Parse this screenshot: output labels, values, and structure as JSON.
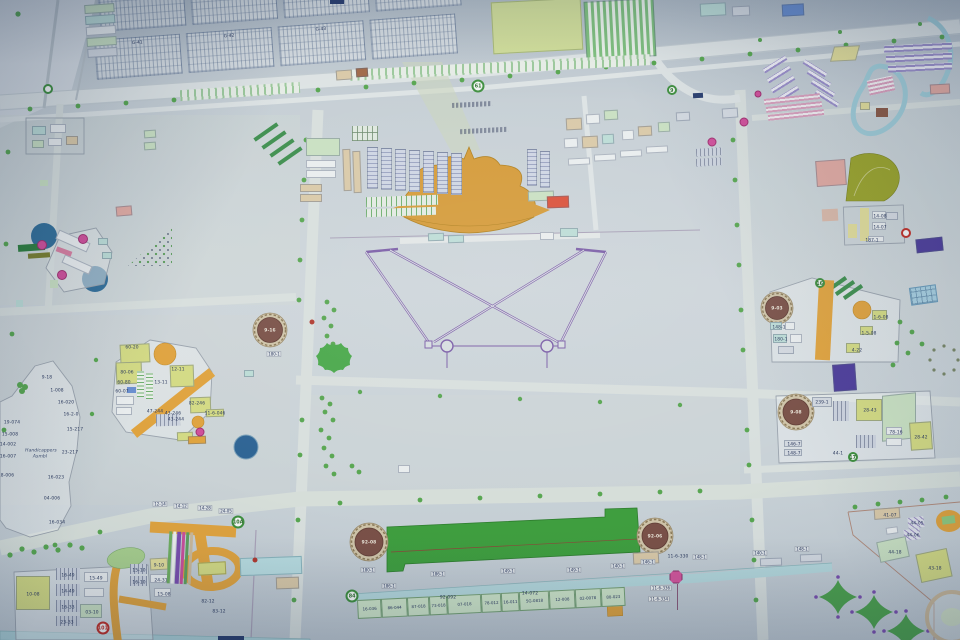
{
  "map": {
    "parking": {
      "row1": [
        {
          "t": "10-44"
        },
        {
          "t": "G-31"
        },
        {
          "t": "G-36"
        },
        {
          "t": ""
        }
      ],
      "row2": [
        {
          "t": "G-41"
        },
        {
          "t": "G-42"
        },
        {
          "t": "G-43"
        },
        {
          "t": ""
        }
      ]
    },
    "bottom_row": {
      "cells": [
        {
          "t": "16-036",
          "w": 24
        },
        {
          "t": "86-044",
          "w": 26
        },
        {
          "t": "87-018",
          "w": 22
        },
        {
          "t": "73-018",
          "w": 18
        },
        {
          "t": "07-018",
          "w": 34
        },
        {
          "t": "78-012",
          "w": 20
        },
        {
          "t": "16-011",
          "w": 18
        },
        {
          "t": "5G-0818",
          "w": 30
        },
        {
          "t": "12-008",
          "w": 26
        },
        {
          "t": "02-0078",
          "w": 26
        },
        {
          "t": "80-023",
          "w": 24
        }
      ]
    },
    "labels": [
      {
        "t": "10-08",
        "x": 33,
        "y": 594
      },
      {
        "t": "16-49",
        "x": 68,
        "y": 575
      },
      {
        "t": "14-49",
        "x": 68,
        "y": 591
      },
      {
        "t": "16-33",
        "x": 68,
        "y": 607
      },
      {
        "t": "23-33",
        "x": 67,
        "y": 622
      },
      {
        "t": "15-49",
        "x": 96,
        "y": 578
      },
      {
        "t": "03-10",
        "x": 92,
        "y": 612
      },
      {
        "t": "9-10",
        "x": 159,
        "y": 565
      },
      {
        "t": "15-10",
        "x": 139,
        "y": 570
      },
      {
        "t": "16-10",
        "x": 139,
        "y": 582
      },
      {
        "t": "24-31",
        "x": 161,
        "y": 580
      },
      {
        "t": "15-08",
        "x": 164,
        "y": 594
      },
      {
        "t": "82-12",
        "x": 208,
        "y": 601
      },
      {
        "t": "83-12",
        "x": 219,
        "y": 611
      },
      {
        "t": "92-092",
        "x": 448,
        "y": 597
      },
      {
        "t": "14-072",
        "x": 530,
        "y": 593
      },
      {
        "t": "11-6-046",
        "x": 215,
        "y": 413
      },
      {
        "t": "11-6-330",
        "x": 678,
        "y": 556
      },
      {
        "t": "9-18",
        "x": 47,
        "y": 377
      },
      {
        "t": "1-008",
        "x": 57,
        "y": 390
      },
      {
        "t": "16-020",
        "x": 66,
        "y": 402
      },
      {
        "t": "16-2-0",
        "x": 71,
        "y": 414
      },
      {
        "t": "15-217",
        "x": 75,
        "y": 429
      },
      {
        "t": "23-217",
        "x": 70,
        "y": 452
      },
      {
        "t": "16-023",
        "x": 56,
        "y": 477
      },
      {
        "t": "04-006",
        "x": 52,
        "y": 498
      },
      {
        "t": "16-034",
        "x": 57,
        "y": 522
      },
      {
        "t": "19-074",
        "x": 12,
        "y": 422
      },
      {
        "t": "15-008",
        "x": 10,
        "y": 434
      },
      {
        "t": "14-002",
        "x": 8,
        "y": 444
      },
      {
        "t": "16-007",
        "x": 8,
        "y": 456
      },
      {
        "t": "18-006",
        "x": 6,
        "y": 475
      },
      {
        "t": "Handicappers",
        "x": 41,
        "y": 450,
        "cls": "ital"
      },
      {
        "t": "Asmbl",
        "x": 40,
        "y": 456,
        "cls": "ital"
      },
      {
        "t": "60-20",
        "x": 132,
        "y": 347
      },
      {
        "t": "80-06",
        "x": 127,
        "y": 372
      },
      {
        "t": "60-80",
        "x": 124,
        "y": 382
      },
      {
        "t": "60-07",
        "x": 122,
        "y": 391
      },
      {
        "t": "12-11",
        "x": 178,
        "y": 369
      },
      {
        "t": "13-11",
        "x": 161,
        "y": 382
      },
      {
        "t": "82-246",
        "x": 197,
        "y": 403
      },
      {
        "t": "47-244",
        "x": 155,
        "y": 411
      },
      {
        "t": "43-246",
        "x": 173,
        "y": 413
      },
      {
        "t": "43-244",
        "x": 176,
        "y": 419
      },
      {
        "t": "148-1",
        "x": 779,
        "y": 327
      },
      {
        "t": "180-1",
        "x": 781,
        "y": 339
      },
      {
        "t": "1-6-08",
        "x": 881,
        "y": 317
      },
      {
        "t": "1-5-08",
        "x": 869,
        "y": 333
      },
      {
        "t": "4-22",
        "x": 857,
        "y": 350
      },
      {
        "t": "239-1",
        "x": 822,
        "y": 402
      },
      {
        "t": "28-43",
        "x": 870,
        "y": 410
      },
      {
        "t": "28-42",
        "x": 921,
        "y": 437
      },
      {
        "t": "78-16",
        "x": 896,
        "y": 432
      },
      {
        "t": "146-7",
        "x": 794,
        "y": 444
      },
      {
        "t": "148-7",
        "x": 794,
        "y": 453
      },
      {
        "t": "44-1",
        "x": 838,
        "y": 453
      },
      {
        "t": "14-08",
        "x": 880,
        "y": 216
      },
      {
        "t": "14-07",
        "x": 880,
        "y": 227
      },
      {
        "t": "187-1",
        "x": 872,
        "y": 240
      },
      {
        "t": "41-07",
        "x": 890,
        "y": 515
      },
      {
        "t": "44-05",
        "x": 917,
        "y": 523
      },
      {
        "t": "44-06",
        "x": 913,
        "y": 535
      },
      {
        "t": "44-18",
        "x": 895,
        "y": 552
      },
      {
        "t": "43-18",
        "x": 935,
        "y": 568
      },
      {
        "t": "92-08",
        "x": 369,
        "y": 542,
        "cls": "ondark"
      },
      {
        "t": "92-06",
        "x": 655,
        "y": 536,
        "cls": "ondark"
      },
      {
        "t": "9-16",
        "x": 270,
        "y": 330,
        "cls": "ondark"
      },
      {
        "t": "9-03",
        "x": 777,
        "y": 308,
        "cls": "ondark"
      },
      {
        "t": "9-08",
        "x": 796,
        "y": 412,
        "cls": "ondark"
      }
    ],
    "tags": [
      {
        "t": "180-1",
        "x": 368,
        "y": 570
      },
      {
        "t": "186-1",
        "x": 389,
        "y": 586
      },
      {
        "t": "186-1",
        "x": 438,
        "y": 574
      },
      {
        "t": "149-1",
        "x": 508,
        "y": 571
      },
      {
        "t": "149-1",
        "x": 574,
        "y": 570
      },
      {
        "t": "140-1",
        "x": 618,
        "y": 566
      },
      {
        "t": "146-1",
        "x": 648,
        "y": 562
      },
      {
        "t": "148-1",
        "x": 700,
        "y": 557
      },
      {
        "t": "140-1",
        "x": 760,
        "y": 553
      },
      {
        "t": "148-1",
        "x": 802,
        "y": 549
      },
      {
        "t": "180-1",
        "x": 274,
        "y": 354
      },
      {
        "t": "12-14",
        "x": 160,
        "y": 504
      },
      {
        "t": "14-12",
        "x": 181,
        "y": 506
      },
      {
        "t": "14-28",
        "x": 205,
        "y": 508
      },
      {
        "t": "24-05",
        "x": 226,
        "y": 511
      }
    ],
    "boxed": [
      {
        "t": "11-6-336",
        "x": 661,
        "y": 588
      },
      {
        "t": "11-6-334",
        "x": 659,
        "y": 599
      }
    ],
    "badges": [
      {
        "t": "101",
        "x": 103,
        "y": 628,
        "cls": "br"
      },
      {
        "t": "",
        "x": 906,
        "y": 233,
        "cls": "br sm"
      },
      {
        "t": "84",
        "x": 352,
        "y": 596,
        "cls": "bg"
      },
      {
        "t": "10A",
        "x": 238,
        "y": 522,
        "cls": "bg"
      },
      {
        "t": "16",
        "x": 820,
        "y": 283,
        "cls": "bg sm"
      },
      {
        "t": "17",
        "x": 853,
        "y": 457,
        "cls": "bg sm"
      },
      {
        "t": "61",
        "x": 478,
        "y": 86,
        "cls": "bg"
      },
      {
        "t": "9",
        "x": 672,
        "y": 90,
        "cls": "bg sm"
      },
      {
        "t": "",
        "x": 48,
        "y": 89,
        "cls": "bg sm"
      },
      {
        "t": "",
        "x": 676,
        "y": 577,
        "cls": "boct"
      },
      {
        "t": "",
        "x": 712,
        "y": 142,
        "cls": "bm"
      },
      {
        "t": "",
        "x": 744,
        "y": 122,
        "cls": "bm"
      },
      {
        "t": "",
        "x": 758,
        "y": 94,
        "cls": "bm sm"
      },
      {
        "t": "",
        "x": 200,
        "y": 432,
        "cls": "bm"
      },
      {
        "t": "",
        "x": 42,
        "y": 245,
        "cls": "bm lg"
      },
      {
        "t": "",
        "x": 83,
        "y": 239,
        "cls": "bm lg"
      },
      {
        "t": "",
        "x": 62,
        "y": 275,
        "cls": "bm lg"
      },
      {
        "t": "",
        "x": 255,
        "y": 560,
        "cls": "dr"
      },
      {
        "t": "",
        "x": 312,
        "y": 322,
        "cls": "dr"
      }
    ],
    "palette": {
      "paper": "#cdd5da",
      "road": "#dde3e4",
      "dome_orange": "#d49a38",
      "service_orange": "#dfa33f",
      "long_building_green": "#3f9e3f",
      "tank_brown": "#7a5148",
      "pond_blue": "#2e6e99",
      "canal_blue": "#b5d8dc",
      "promenade_purple": "#7b5ea7",
      "deep_purple": "#4f3f9b",
      "magenta": "#cf4f9a",
      "tree_green": "#58a651",
      "light_green_bldg": "#c9e0c2",
      "yellow_green": "#d3da84"
    }
  }
}
